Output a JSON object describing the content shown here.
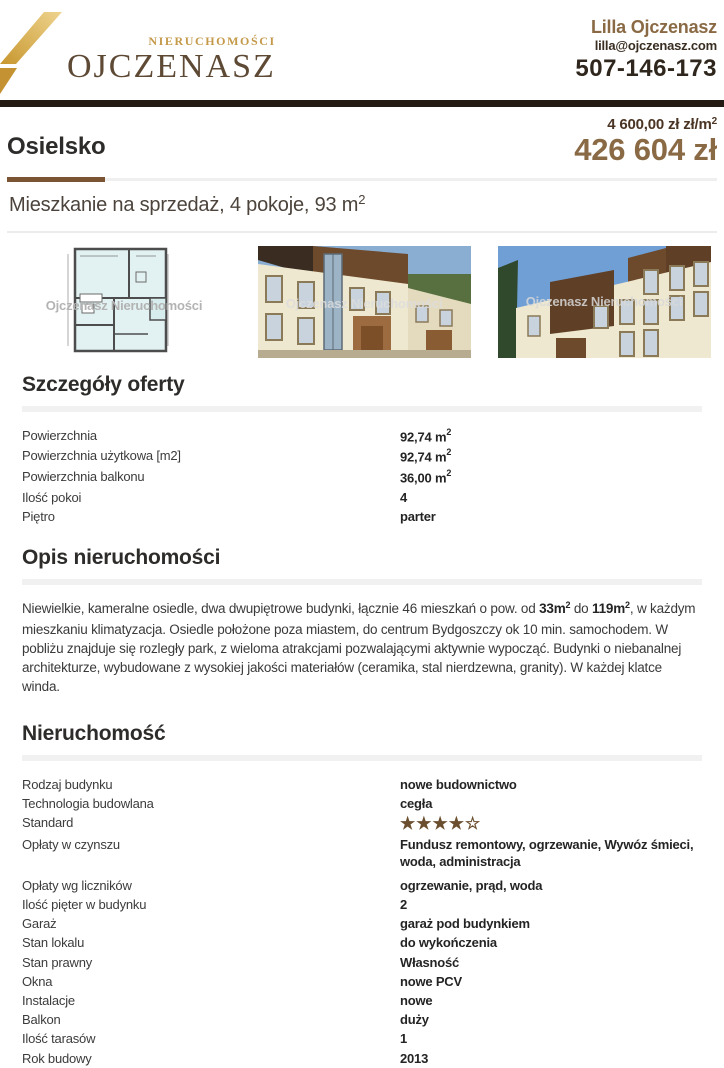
{
  "brand": {
    "tagline": "NIERUCHOMOŚCI",
    "name": "OJCZENASZ"
  },
  "agent": {
    "name": "Lilla Ojczenasz",
    "email": "lilla@ojczenasz.com",
    "phone": "507-146-173"
  },
  "listing": {
    "location": "Osielsko",
    "price_per_m2": "4 600,00 zł zł/m",
    "price_per_m2_sup": "2",
    "price_total": "426 604 zł",
    "subtitle": "Mieszkanie na sprzedaż, 4 pokoje, 93 m",
    "subtitle_sup": "2"
  },
  "photos": {
    "watermark": "Ojczenasz Nieruchomości",
    "items": [
      "floor-plan",
      "building-front",
      "building-side"
    ]
  },
  "details": {
    "heading": "Szczegóły oferty",
    "rows": [
      {
        "label": "Powierzchnia",
        "value": "92,74 m",
        "sup": "2"
      },
      {
        "label": "Powierzchnia użytkowa [m2]",
        "value": "92,74 m",
        "sup": "2"
      },
      {
        "label": "Powierzchnia balkonu",
        "value": "36,00 m",
        "sup": "2"
      },
      {
        "label": "Ilość pokoi",
        "value": "4"
      },
      {
        "label": "Piętro",
        "value": "parter"
      }
    ]
  },
  "description": {
    "heading": "Opis nieruchomości",
    "segments": [
      {
        "text": "Niewielkie, kameralne osiedle, dwa dwupiętrowe budynki, łącznie 46 mieszkań o pow. od "
      },
      {
        "text": "33m",
        "bold": true
      },
      {
        "text": "2",
        "bold": true,
        "sup": true
      },
      {
        "text": " do "
      },
      {
        "text": "119m",
        "bold": true
      },
      {
        "text": "2",
        "bold": true,
        "sup": true
      },
      {
        "text": ", w każdym mieszkaniu klimatyzacja. Osiedle położone poza miastem, do centrum Bydgoszczy ok 10 min. samochodem. W pobliżu znajduje się rozległy park, z wieloma atrakcjami pozwalającymi aktywnie wypocząć. Budynki o niebanalnej architekturze, wybudowane z wysokiej jakości materiałów (ceramika, stal nierdzewna, granity). W każdej klatce winda."
      }
    ]
  },
  "property": {
    "heading": "Nieruchomość",
    "rows": [
      {
        "label": "Rodzaj budynku",
        "value": "nowe budownictwo"
      },
      {
        "label": "Technologia budowlana",
        "value": "cegła"
      },
      {
        "label": "Standard",
        "stars": 4,
        "stars_total": 5
      },
      {
        "label": "Opłaty w czynszu",
        "value_lines": [
          "Fundusz remontowy, ogrzewanie, Wywóz śmieci,",
          "woda, administracja"
        ]
      },
      {
        "label": "Opłaty wg liczników",
        "value": "ogrzewanie, prąd, woda"
      },
      {
        "label": "Ilość pięter w budynku",
        "value": "2"
      },
      {
        "label": "Garaż",
        "value": "garaż pod budynkiem"
      },
      {
        "label": "Stan lokalu",
        "value": "do wykończenia"
      },
      {
        "label": "Stan prawny",
        "value": "Własność"
      },
      {
        "label": "Okna",
        "value": "nowe PCV"
      },
      {
        "label": "Instalacje",
        "value": "nowe"
      },
      {
        "label": "Balkon",
        "value": "duży"
      },
      {
        "label": "Ilość tarasów",
        "value": "1"
      },
      {
        "label": "Rok budowy",
        "value": "2013"
      }
    ]
  },
  "colors": {
    "brand_gold": "#c49a4a",
    "brand_brown": "#5d4934",
    "accent_brown": "#7a5433",
    "price_brown": "#8a6a45",
    "price_dark": "#4a3423",
    "top_bar": "#241a14",
    "star_brown": "#6b4e2e"
  }
}
